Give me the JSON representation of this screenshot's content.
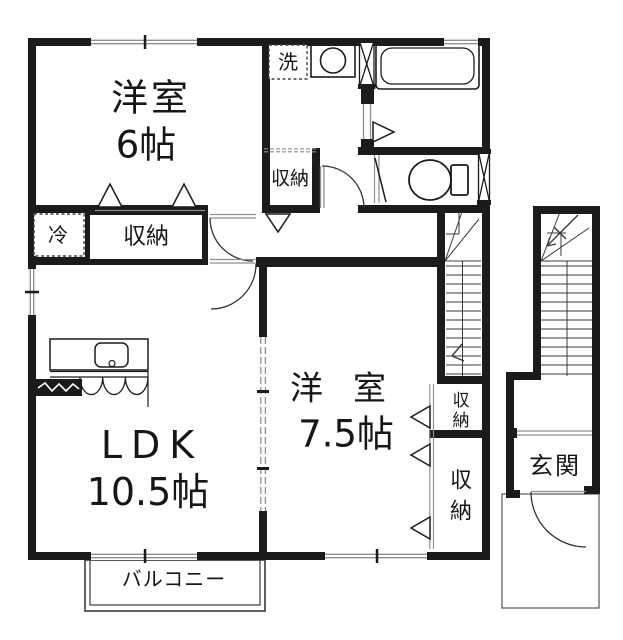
{
  "meta": {
    "type": "floorplan",
    "colors": {
      "ink": "#1b1b1b",
      "line_gray": "#8f8f8f",
      "background": "#ffffff"
    }
  },
  "rooms": {
    "bedroom1": {
      "name": "洋室",
      "size": "6帖"
    },
    "ldk": {
      "name": "LDK",
      "size": "10.5帖"
    },
    "bedroom2": {
      "name": "洋室",
      "size": "7.5帖"
    },
    "entrance": {
      "label": "玄関"
    },
    "balcony": {
      "label": "バルコニー"
    }
  },
  "fixtures": {
    "laundry": {
      "label": "洗"
    },
    "refrigerator": {
      "label": "冷"
    },
    "closet_hall": {
      "label": "収納"
    },
    "closet_bedroom1": {
      "label": "収納"
    },
    "closet_bedroom2_upper": {
      "label": "収納"
    },
    "closet_bedroom2_lower": {
      "label": "収納"
    }
  },
  "icons": [
    "bathtub-icon",
    "washing-machine-icon",
    "toilet-icon",
    "kitchen-sink-icon",
    "stove-icon",
    "interior-stairs-icon",
    "exterior-stairs-icon",
    "door-arc-icon",
    "window-icon",
    "closet-door-triangle-icon"
  ]
}
